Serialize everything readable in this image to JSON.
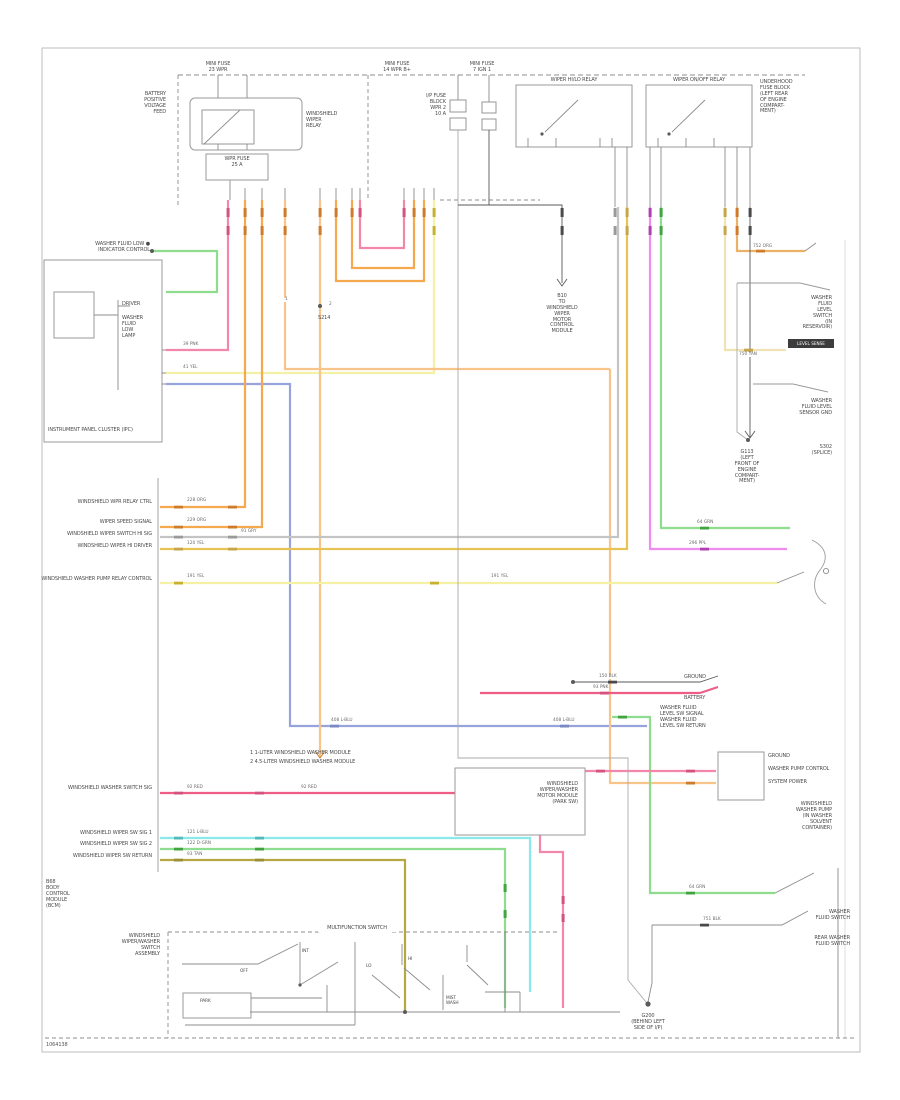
{
  "L": {
    "t_fuse1": "MINI FUSE\n23 WPR",
    "t_fuse2": "MINI FUSE\n14 WPR B+",
    "t_fuse3": "MINI FUSE\n7 IGN 1",
    "t_relay_left": "BATTERY\nPOSITIVE\nVOLTAGE\nFEED",
    "t_relay_right": "WINDSHIELD\nWIPER\nRELAY",
    "t_relay_sub": "WPR FUSE\n25 A",
    "t_f1": "I/P FUSE\nBLOCK\nWPR 2\n10 A",
    "t_s1_title": "WIPER HI/LO RELAY",
    "t_s2_title": "WIPER ON/OFF RELAY",
    "t_ufb": "UNDERHOOD\nFUSE BLOCK\n(LEFT REAR\nOF ENGINE\nCOMPART-\nMENT)",
    "t_b10": "B10\nTO\nWINDSHIELD\nWIPER\nMOTOR\nCONTROL\nMODULE",
    "t_g113": "G113\n(LEFT\nFRONT OF\nENGINE\nCOMPART-\nMENT)",
    "t_wfl": "WASHER FLUID LOW ●\nINDICATOR CONTROL",
    "t_drv": "DRIVER",
    "t_lamp": "WASHER\nFLUID\nLOW\nLAMP",
    "t_ipc": "INSTRUMENT PANEL CLUSTER (IPC)",
    "b1": "WINDSHIELD WPR RELAY CTRL",
    "b2": "WIPER SPEED SIGNAL",
    "b3": "WINDSHIELD WIPER SWITCH HI SIG",
    "b4": "WINDSHIELD WIPER HI DRIVER",
    "b5": "WINDSHIELD WASHER PUMP RELAY CONTROL",
    "b6": "WINDSHIELD WASHER SWITCH SIG",
    "b7": "WINDSHIELD WIPER SW SIG 1",
    "b8": "WINDSHIELD WIPER SW SIG 2",
    "b9": "WINDSHIELD WIPER SW RETURN",
    "t_bcm": "B68\nBODY\nCONTROL\nMODULE\n(BCM)",
    "n1": "1   1-LITER WINDSHIELD WASHER MODULE",
    "n2": "2   4.5-LITER WINDSHIELD WASHER MODULE",
    "t_boxb": "WINDSHIELD\nWIPER/WASHER\nMOTOR MODULE\n(PARK SW)",
    "t_sw_left": "WINDSHIELD\nWIPER/WASHER\nSWITCH\nASSEMBLY",
    "t_sw_top": "MULTIFUNCTION SWITCH",
    "s_off": "OFF",
    "s_int": "INT",
    "s_lo": "LO",
    "s_hi": "HI",
    "s_mist": "MIST\nWASH",
    "s_park": "PARK",
    "t_g200": "G200\n(BEHIND LEFT\nSIDE OF I/P)",
    "r_gnd": "GROUND",
    "r_bat": "BATTERY",
    "r_wfls": "WASHER FLUID\nLEVEL SW SIGNAL\nWASHER FLUID\nLEVEL SW RETURN",
    "rp1": "GROUND",
    "rp2": "WASHER PUMP CONTROL",
    "rp3": "SYSTEM POWER",
    "r_pump": "WINDSHIELD\nWASHER PUMP\n(IN WASHER\nSOLVENT\nCONTAINER)",
    "u1": "WASHER\nFLUID\nLEVEL\nSWITCH\n(IN\nRESERVOIR)",
    "u_bar": "LEVEL SENSE",
    "u2": "WASHER\nFLUID LEVEL\nSENSOR GND",
    "u3": "S302\n(SPLICE)",
    "br1": "WASHER\nFLUID SWITCH",
    "br2": "REAR WASHER\nFLUID SWITCH",
    "t_s214": "S214",
    "footer": "1064138"
  },
  "K": {
    "k_pnk": "39 PNK",
    "k_yel": "41 YEL",
    "k_blu": "408 L-BLU",
    "k_blu2": "408 L-BLU",
    "k_o1": "228 ORG",
    "k_o2": "229 ORG",
    "k_gry": "91 GRY",
    "k_dyel": "120 YEL",
    "k_yel2": "191 YEL",
    "k_yel3": "191 YEL",
    "k_pnk2": "92 RED",
    "k_pnk3": "92 RED",
    "k_cyn": "121 L-BLU",
    "k_grn": "122 D-GRN",
    "k_tan": "93 TAN",
    "k_mag": "296 PPL",
    "k_grn1": "64 GRN",
    "k_tan1": "752 ORG",
    "k_crm": "750 TAN",
    "k_grnB": "64 GRN",
    "k_blk": "751 BLK",
    "k_pnkR": "93 PNK",
    "k_blkR": "150 BLK",
    "k_n1": "1",
    "k_n2": "2"
  },
  "colors": {
    "pink": "#F287A9",
    "red_pink": "#EE5D86",
    "orange": "#F5A94F",
    "pale_orange": "#F8C489",
    "amber": "#E7C353",
    "pale_yellow": "#F4F0A4",
    "cream": "#EFE3B5",
    "tan": "#EBB267",
    "magenta": "#F08BF0",
    "green": "#8EDC8E",
    "cyan": "#8AEAEA",
    "blue": "#96A3DC",
    "khaki": "#B5A842",
    "gray_wire": "#C4C4C4",
    "black_wire": "#5A5A5A"
  }
}
